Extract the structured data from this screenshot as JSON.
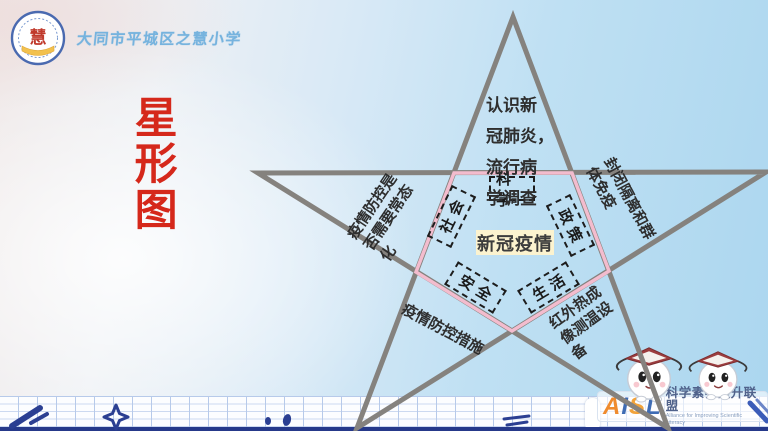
{
  "header": {
    "school_name": "大同市平城区之慧小学",
    "logo_char": "慧"
  },
  "title": {
    "text": "星形图",
    "color": "#d5281b"
  },
  "diagram": {
    "type": "star-diagram",
    "center_label": "新冠疫情",
    "center_bg": "#fcf3cf",
    "star_line_color": "#85827e",
    "pentagon_line_color": "#f3bcce",
    "nodes": [
      {
        "label": "科学"
      },
      {
        "label": "社会"
      },
      {
        "label": "政策"
      },
      {
        "label": "安全"
      },
      {
        "label": "生活"
      }
    ],
    "annotations": {
      "top": "认识新\n冠肺炎，\n流行病\n学调查",
      "left": "疫情防控是\n否需要常态\n化",
      "right": "封闭隔离和群\n体免疫",
      "bottom_left": "疫情防控措施",
      "bottom_right": "红外热成\n像测温设\n备"
    }
  },
  "footer": {
    "logo_letters": [
      {
        "char": "A",
        "color": "#ef8b2e"
      },
      {
        "char": "I",
        "color": "#3f6cb4"
      },
      {
        "char": "S",
        "color": "#f2a33a"
      },
      {
        "char": "L",
        "color": "#3f6cb4"
      }
    ],
    "alliance_cn": "科学素养提升联盟",
    "alliance_en": "Alliance for Improving Scientific Literacy"
  }
}
